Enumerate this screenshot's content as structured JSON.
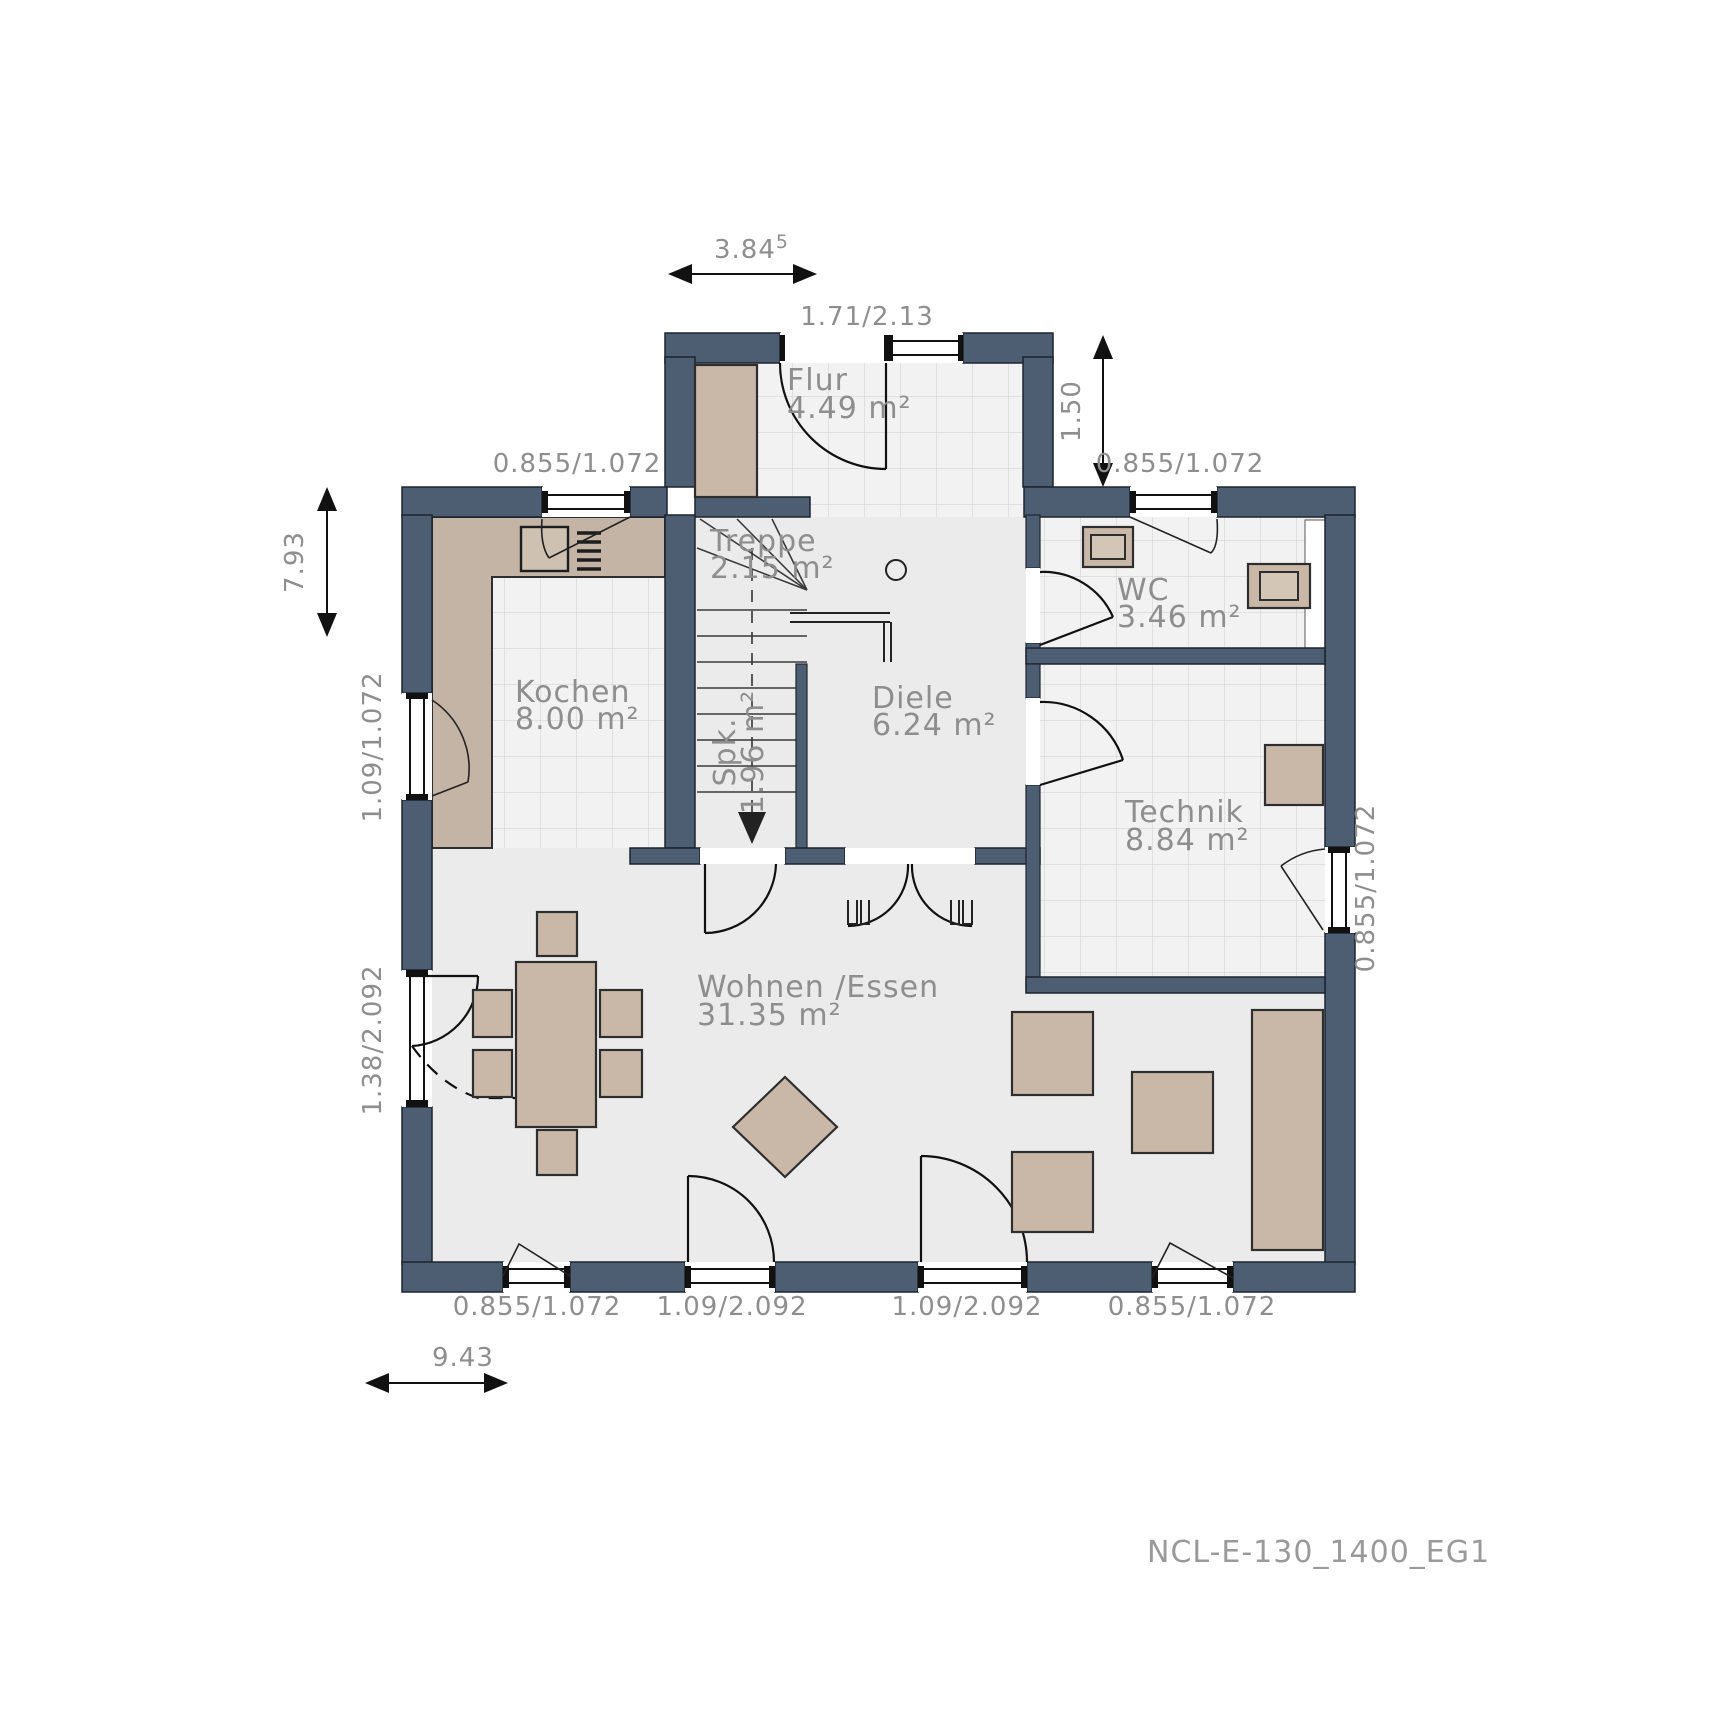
{
  "drawing": {
    "code": "NCL-E-130_1400_EG1"
  },
  "rooms": {
    "flur": {
      "label": "Flur",
      "area": "4.49 m²"
    },
    "treppe": {
      "label": "Treppe",
      "area": "2.15 m²"
    },
    "spk": {
      "label": "Spk.",
      "area": "1.96 m²"
    },
    "wc": {
      "label": "WC",
      "area": "3.46 m²"
    },
    "kochen": {
      "label": "Kochen",
      "area": "8.00 m²"
    },
    "diele": {
      "label": "Diele",
      "area": "6.24 m²"
    },
    "technik": {
      "label": "Technik",
      "area": "8.84 m²"
    },
    "wohnen": {
      "label": "Wohnen /Essen",
      "area": "31.35 m²"
    }
  },
  "dimensions": {
    "top_width_value": "3.84",
    "top_width_sup": "5",
    "entry_door": "1.71/2.13",
    "right_setback": "1.50",
    "left_height": "7.93",
    "bottom_width": "9.43",
    "window_small": "0.855/1.072",
    "window_kitchen": "1.09/1.072",
    "door_side": "1.38/2.092",
    "door_terrace": "1.09/2.092"
  },
  "colors": {
    "wall": "#4e5e72",
    "floor": "#ebebeb",
    "tile": "#f2f2f2",
    "furniture": "#c9b8a7",
    "text": "#8e8e8e"
  }
}
